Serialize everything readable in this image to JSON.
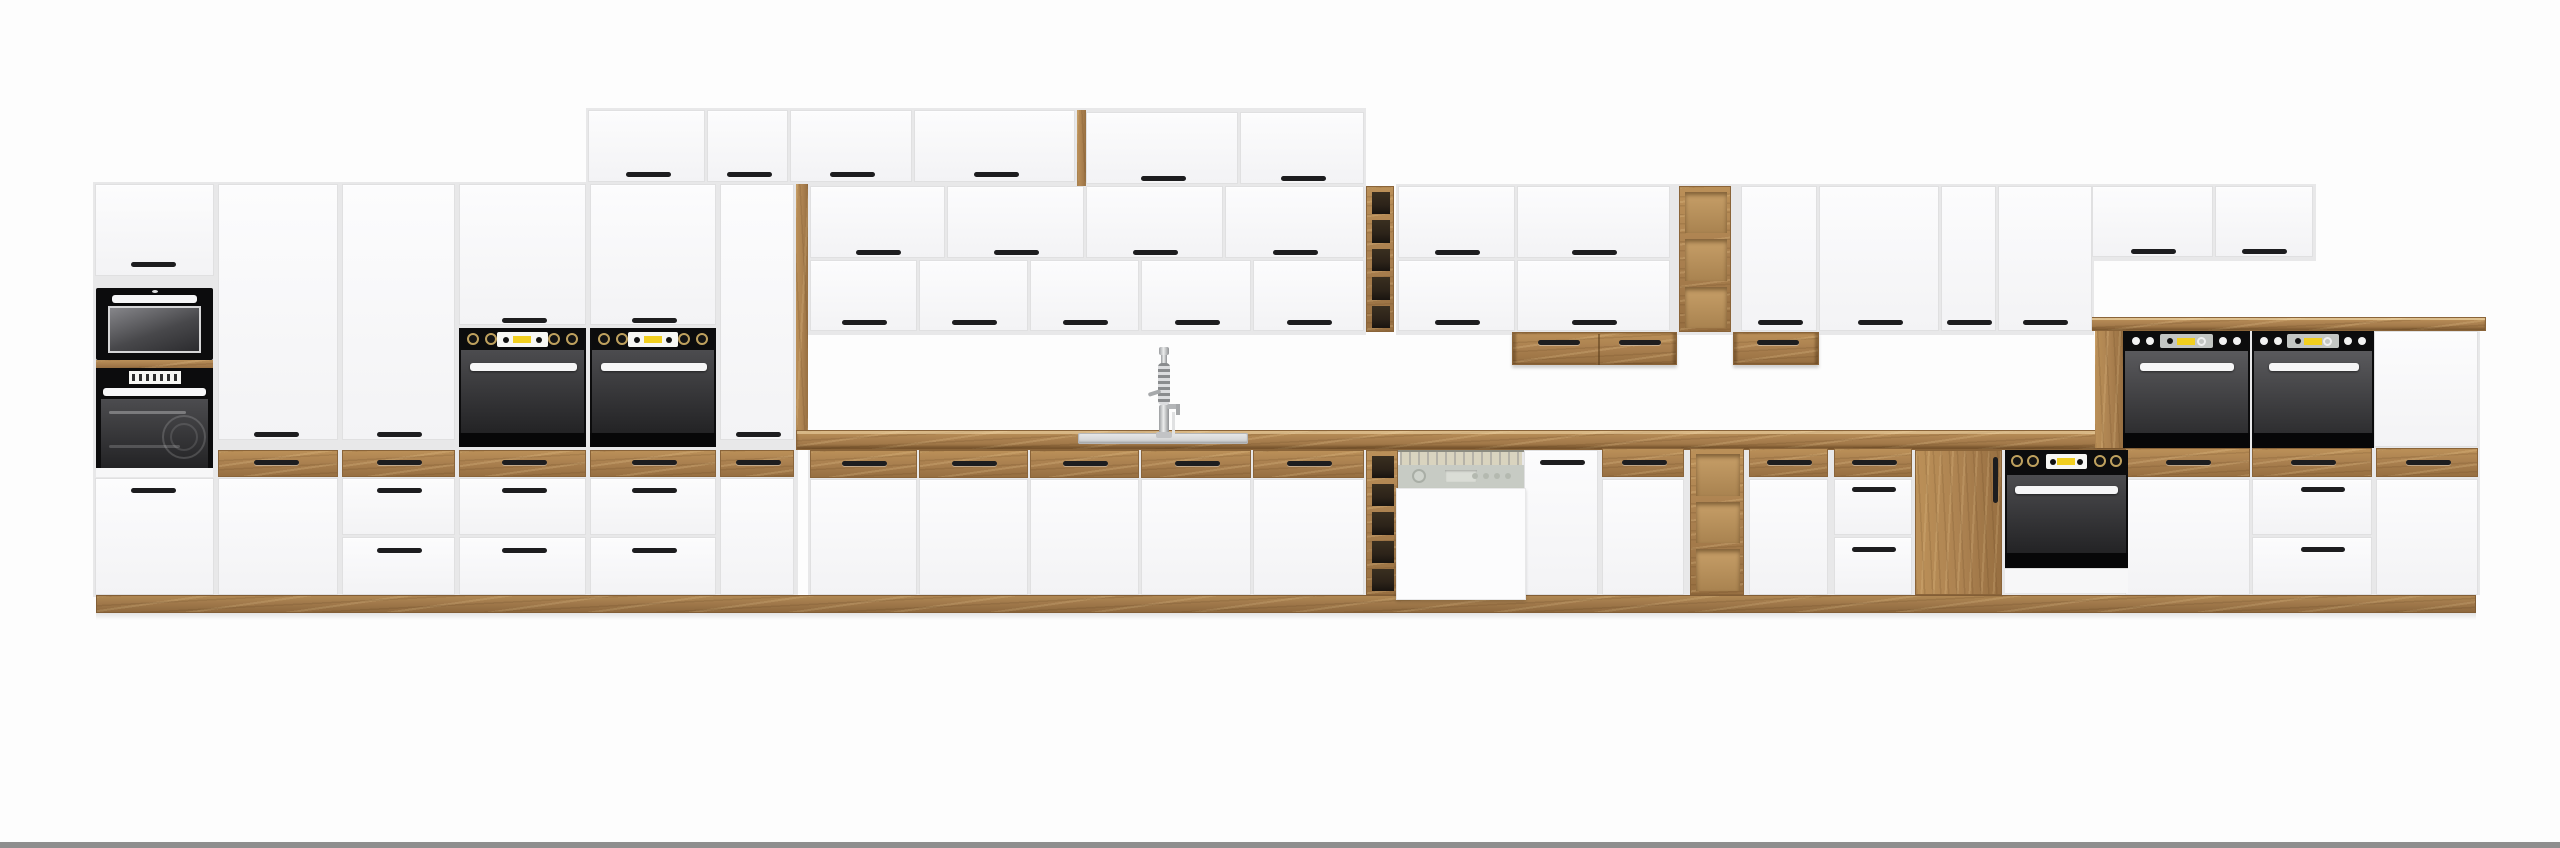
{
  "title": "white-and-oak-kitchen-cabinet-set-product-photo",
  "colors": {
    "background": "#fdfdfd",
    "backing": "#e8e8e9",
    "white_hi": "#fcfcfd",
    "white_lo": "#f3f3f5",
    "seam": "#e0e0e1",
    "wood": "#ab8150",
    "wood_light": "#bb9058",
    "wood_dark": "#976f41",
    "wood_edge": "#8a6439",
    "handle": "#1d1d1f",
    "black": "#0c0c0d",
    "glass_hi": "#4c4c4f",
    "glass_lo": "#232325",
    "bar_white": "#f6f6f7",
    "yellow": "#f2cf1f",
    "display_white": "#f7f7f4",
    "display_gray": "#c3c6c3",
    "knob_ring": "#bfa15e",
    "steel": "#c9cacb",
    "steel_hi": "#e8e9ea",
    "dw_panel": "#c7cbc4",
    "dw_interior": "#d9d4bf",
    "rack_dark": "#2c2319",
    "shelf_light": "#c79f68",
    "bottom_bar": "#8e8e8e"
  },
  "inventory": {
    "front_finish": "white",
    "accent_finish": "oak-wood",
    "appliance_counts": {
      "microwave": 1,
      "built_in_ovens": 6,
      "dishwasher": 1,
      "sink": 1,
      "faucet": 1
    },
    "features": [
      "stacked-top-cabinets",
      "wall-cabinets",
      "tall-oven-towers",
      "wine-rack-columns",
      "open-wood-shelves",
      "wood-drawer-fronts",
      "wood-countertop",
      "wood-plinth",
      "mid-height-double-oven-unit"
    ]
  },
  "modules": [
    [
      "bk",
      93,
      182,
      705,
      415
    ],
    [
      "bk",
      586,
      108,
      780,
      78
    ],
    [
      "bk",
      808,
      184,
      558,
      151
    ],
    [
      "bk",
      1396,
      184,
      698,
      151
    ],
    [
      "bk",
      2090,
      184,
      226,
      77
    ],
    [
      "bk",
      808,
      448,
      1322,
      149
    ],
    [
      "bk",
      2121,
      329,
      359,
      266
    ],
    [
      "ct",
      796,
      430,
      1334,
      20
    ],
    [
      "cap",
      2090,
      317,
      396,
      14
    ],
    [
      "plinth",
      96,
      595,
      2380,
      18
    ],
    [
      "shadow",
      96,
      613,
      2380,
      7
    ],
    [
      "woodv",
      796,
      184,
      12,
      246
    ],
    [
      "woodv",
      1077,
      110,
      9,
      76
    ],
    [
      "woodv",
      2095,
      331,
      28,
      117
    ],
    [
      "wood",
      96,
      360,
      117,
      8
    ],
    [
      "w",
      588,
      110,
      117,
      72,
      647,
      173
    ],
    [
      "w",
      707,
      110,
      81,
      72,
      748,
      173
    ],
    [
      "w",
      790,
      110,
      122,
      72,
      851,
      173
    ],
    [
      "w",
      914,
      110,
      161,
      72,
      995,
      173
    ],
    [
      "w",
      1086,
      112,
      152,
      72,
      1162,
      177
    ],
    [
      "w",
      1240,
      112,
      124,
      72,
      1302,
      177
    ],
    [
      "w",
      95,
      184,
      119,
      92,
      152,
      263
    ],
    [
      "w",
      95,
      478,
      119,
      117,
      152,
      489
    ],
    [
      "w",
      218,
      184,
      120,
      256,
      275,
      433
    ],
    [
      "w",
      218,
      478,
      120,
      117
    ],
    [
      "w",
      342,
      184,
      113,
      256,
      398,
      433
    ],
    [
      "w",
      342,
      478,
      113,
      57,
      398,
      489
    ],
    [
      "w",
      342,
      537,
      113,
      58,
      398,
      549
    ],
    [
      "w",
      459,
      184,
      127,
      141,
      523,
      319
    ],
    [
      "w",
      459,
      478,
      127,
      57,
      523,
      489
    ],
    [
      "w",
      459,
      537,
      127,
      58,
      523,
      549
    ],
    [
      "w",
      590,
      184,
      126,
      141,
      653,
      319
    ],
    [
      "w",
      590,
      478,
      126,
      57,
      653,
      489
    ],
    [
      "w",
      590,
      537,
      126,
      58,
      653,
      549
    ],
    [
      "w",
      720,
      184,
      74,
      256,
      757,
      433
    ],
    [
      "w",
      720,
      478,
      74,
      117
    ],
    [
      "w",
      810,
      186,
      135,
      72,
      877,
      251
    ],
    [
      "w",
      947,
      186,
      137,
      72,
      1015,
      251
    ],
    [
      "w",
      1086,
      186,
      137,
      72,
      1154,
      251
    ],
    [
      "w",
      1225,
      186,
      139,
      72,
      1294,
      251
    ],
    [
      "w",
      810,
      260,
      107,
      71,
      863,
      321
    ],
    [
      "w",
      919,
      260,
      109,
      71,
      973,
      321
    ],
    [
      "w",
      1030,
      260,
      109,
      71,
      1084,
      321
    ],
    [
      "w",
      1141,
      260,
      110,
      71,
      1196,
      321
    ],
    [
      "w",
      1253,
      260,
      111,
      71,
      1308,
      321
    ],
    [
      "w",
      1398,
      186,
      117,
      72,
      1456,
      251
    ],
    [
      "w",
      1517,
      186,
      153,
      72,
      1593,
      251
    ],
    [
      "w",
      1398,
      260,
      117,
      71,
      1456,
      321
    ],
    [
      "w",
      1517,
      260,
      153,
      71,
      1593,
      321
    ],
    [
      "w",
      1741,
      186,
      76,
      145,
      1779,
      321
    ],
    [
      "w",
      1819,
      186,
      120,
      145,
      1879,
      321
    ],
    [
      "w",
      1941,
      186,
      55,
      145,
      1968,
      321
    ],
    [
      "w",
      1998,
      186,
      94,
      145,
      2044,
      321
    ],
    [
      "w",
      2092,
      186,
      121,
      71,
      2152,
      250
    ],
    [
      "w",
      2215,
      186,
      98,
      71,
      2263,
      250
    ],
    [
      "w",
      810,
      479,
      107,
      116
    ],
    [
      "w",
      919,
      479,
      109,
      116
    ],
    [
      "w",
      1030,
      479,
      109,
      116
    ],
    [
      "w",
      1141,
      479,
      110,
      116
    ],
    [
      "w",
      1253,
      479,
      111,
      116
    ],
    [
      "w",
      1524,
      450,
      74,
      145,
      1561,
      461
    ],
    [
      "w",
      1602,
      479,
      82,
      116
    ],
    [
      "w",
      1749,
      479,
      79,
      116
    ],
    [
      "w",
      1834,
      479,
      78,
      56,
      1873,
      488,
      44
    ],
    [
      "w",
      1834,
      537,
      78,
      58,
      1873,
      548,
      44
    ],
    [
      "w",
      2374,
      331,
      104,
      116
    ],
    [
      "w",
      2125,
      479,
      125,
      116
    ],
    [
      "w",
      2252,
      479,
      120,
      56,
      2322,
      488,
      44
    ],
    [
      "w",
      2252,
      537,
      120,
      58,
      2322,
      548,
      44
    ],
    [
      "w",
      2376,
      479,
      102,
      116
    ],
    [
      "wd",
      218,
      450,
      120,
      27,
      275,
      461
    ],
    [
      "wd",
      342,
      450,
      113,
      27,
      398,
      461
    ],
    [
      "wd",
      459,
      450,
      127,
      27,
      523,
      461
    ],
    [
      "wd",
      590,
      450,
      126,
      27,
      653,
      461
    ],
    [
      "wd",
      720,
      450,
      74,
      27,
      757,
      461
    ],
    [
      "wd",
      810,
      450,
      107,
      28,
      863,
      462
    ],
    [
      "wd",
      919,
      450,
      109,
      28,
      973,
      462
    ],
    [
      "wd",
      1030,
      450,
      109,
      28,
      1084,
      462
    ],
    [
      "wd",
      1141,
      450,
      110,
      28,
      1196,
      462
    ],
    [
      "wd",
      1253,
      450,
      111,
      28,
      1308,
      462
    ],
    [
      "wd",
      1602,
      448,
      82,
      29,
      1643,
      461
    ],
    [
      "wd",
      1749,
      448,
      79,
      29,
      1788,
      461
    ],
    [
      "wd",
      1834,
      448,
      78,
      29,
      1873,
      461
    ],
    [
      "wd",
      2125,
      448,
      125,
      29,
      2187,
      461
    ],
    [
      "wd",
      2252,
      448,
      120,
      29,
      2312,
      461
    ],
    [
      "wd",
      2376,
      448,
      102,
      29,
      2427,
      461
    ],
    [
      "wdoor",
      1915,
      450,
      87,
      145
    ],
    [
      "ubox",
      1512,
      332,
      165,
      33,
      [
        [
          1558,
          341
        ],
        [
          1639,
          341
        ]
      ],
      1597
    ],
    [
      "ubox",
      1733,
      332,
      86,
      33,
      [
        [
          1777,
          341
        ]
      ],
      0
    ],
    [
      "rack",
      1366,
      186,
      28,
      146,
      "dark",
      5
    ],
    [
      "rack",
      1366,
      450,
      32,
      145,
      "dark",
      5
    ],
    [
      "rack",
      1679,
      186,
      52,
      146,
      "light",
      3
    ],
    [
      "rack",
      1690,
      448,
      54,
      147,
      "light",
      3
    ],
    [
      "mw",
      96,
      288,
      117,
      72
    ],
    [
      "ovLcd",
      96,
      368,
      117,
      109
    ],
    [
      "ovA",
      459,
      328,
      127,
      119
    ],
    [
      "ovA",
      590,
      328,
      126,
      119
    ],
    [
      "ovB",
      2123,
      331,
      127,
      117
    ],
    [
      "ovB",
      2252,
      331,
      122,
      117
    ],
    [
      "ovBase",
      2005,
      450,
      123,
      143
    ],
    [
      "dw",
      1398,
      450,
      126,
      150
    ],
    [
      "sink",
      1078,
      433,
      170,
      11
    ],
    [
      "faucet",
      1164,
      347
    ],
    [
      "bar",
      0,
      842,
      2560,
      6
    ]
  ]
}
